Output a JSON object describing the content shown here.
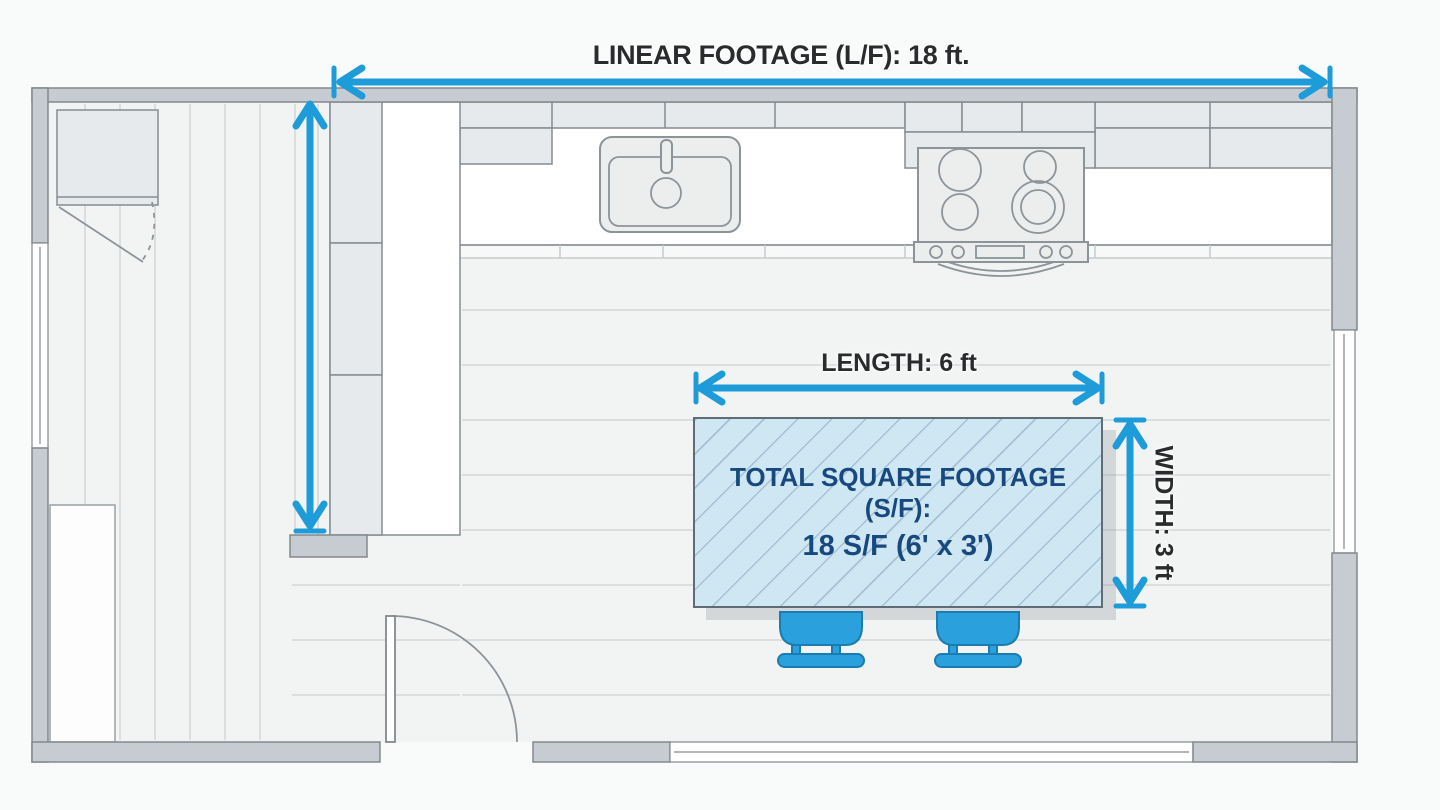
{
  "page": {
    "background": "#f9fafa"
  },
  "header": {
    "title": "LINEAR FOOTAGE (L/F): 18 ft."
  },
  "labels": {
    "length": "LENGTH: 6 ft",
    "width": "WIDTH: 3 ft"
  },
  "island": {
    "line1": "TOTAL SQUARE FOOTAGE (S/F):",
    "line2": "18 S/F (6' x 3')"
  },
  "measurements": {
    "linear_footage_ft": 18,
    "island_length_ft": 6,
    "island_width_ft": 3,
    "island_square_footage_sf": 18
  },
  "icons": {
    "linear-footage-arrow": "horizontal double-headed dimension arrow",
    "left-height-arrow": "vertical double-headed dimension arrow",
    "length-arrow": "horizontal double-headed dimension arrow",
    "width-arrow": "vertical double-headed dimension arrow"
  },
  "colors": {
    "pageBg": "#f9fafa",
    "arrow": "#1e9cd9",
    "islandFill": "#cfe6f3",
    "islandHatch": "#9fbfd3",
    "islandText": "#17497e",
    "islandBorder": "#5e6c76",
    "labelText": "#2a2b2d",
    "wallFill": "#c6ccd1",
    "wallStroke": "#82898e",
    "cabinetFill": "#e6eaec",
    "cabinetStroke": "#858c91",
    "counterFill": "#ffffff",
    "floorFill": "#f2f3f3",
    "floorLine": "#dadedf",
    "stoolFill": "#2aa0dc",
    "stoolStroke": "#1a7cb0"
  }
}
